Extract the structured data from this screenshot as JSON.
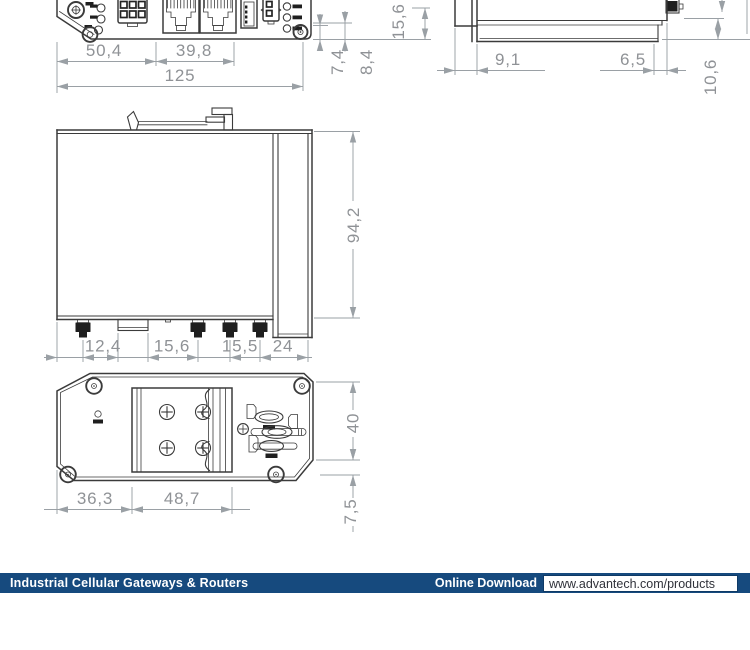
{
  "drawing": {
    "object_color": "#3b3b3b",
    "dim_color": "#9aa0a5",
    "dims": {
      "front_w1": "50,4",
      "front_w2": "39,8",
      "front_total": "125",
      "front_h1": "7,4",
      "front_h2": "8,4",
      "front_h3": "15,6",
      "side_d1": "9,1",
      "side_d2": "6,5",
      "side_d3": "10,6",
      "profile_h": "94,2",
      "profile_b1": "12,4",
      "profile_b2": "15,6",
      "profile_b3": "15,5",
      "profile_b4": "24",
      "bottom_w1": "36,3",
      "bottom_w2": "48,7",
      "bottom_h": "40",
      "bottom_o": "7,5"
    }
  },
  "footer": {
    "category_label": "Industrial Cellular Gateways & Routers",
    "download_label": "Online Download",
    "download_url": "www.advantech.com/products",
    "bar_color": "#164a7e"
  }
}
